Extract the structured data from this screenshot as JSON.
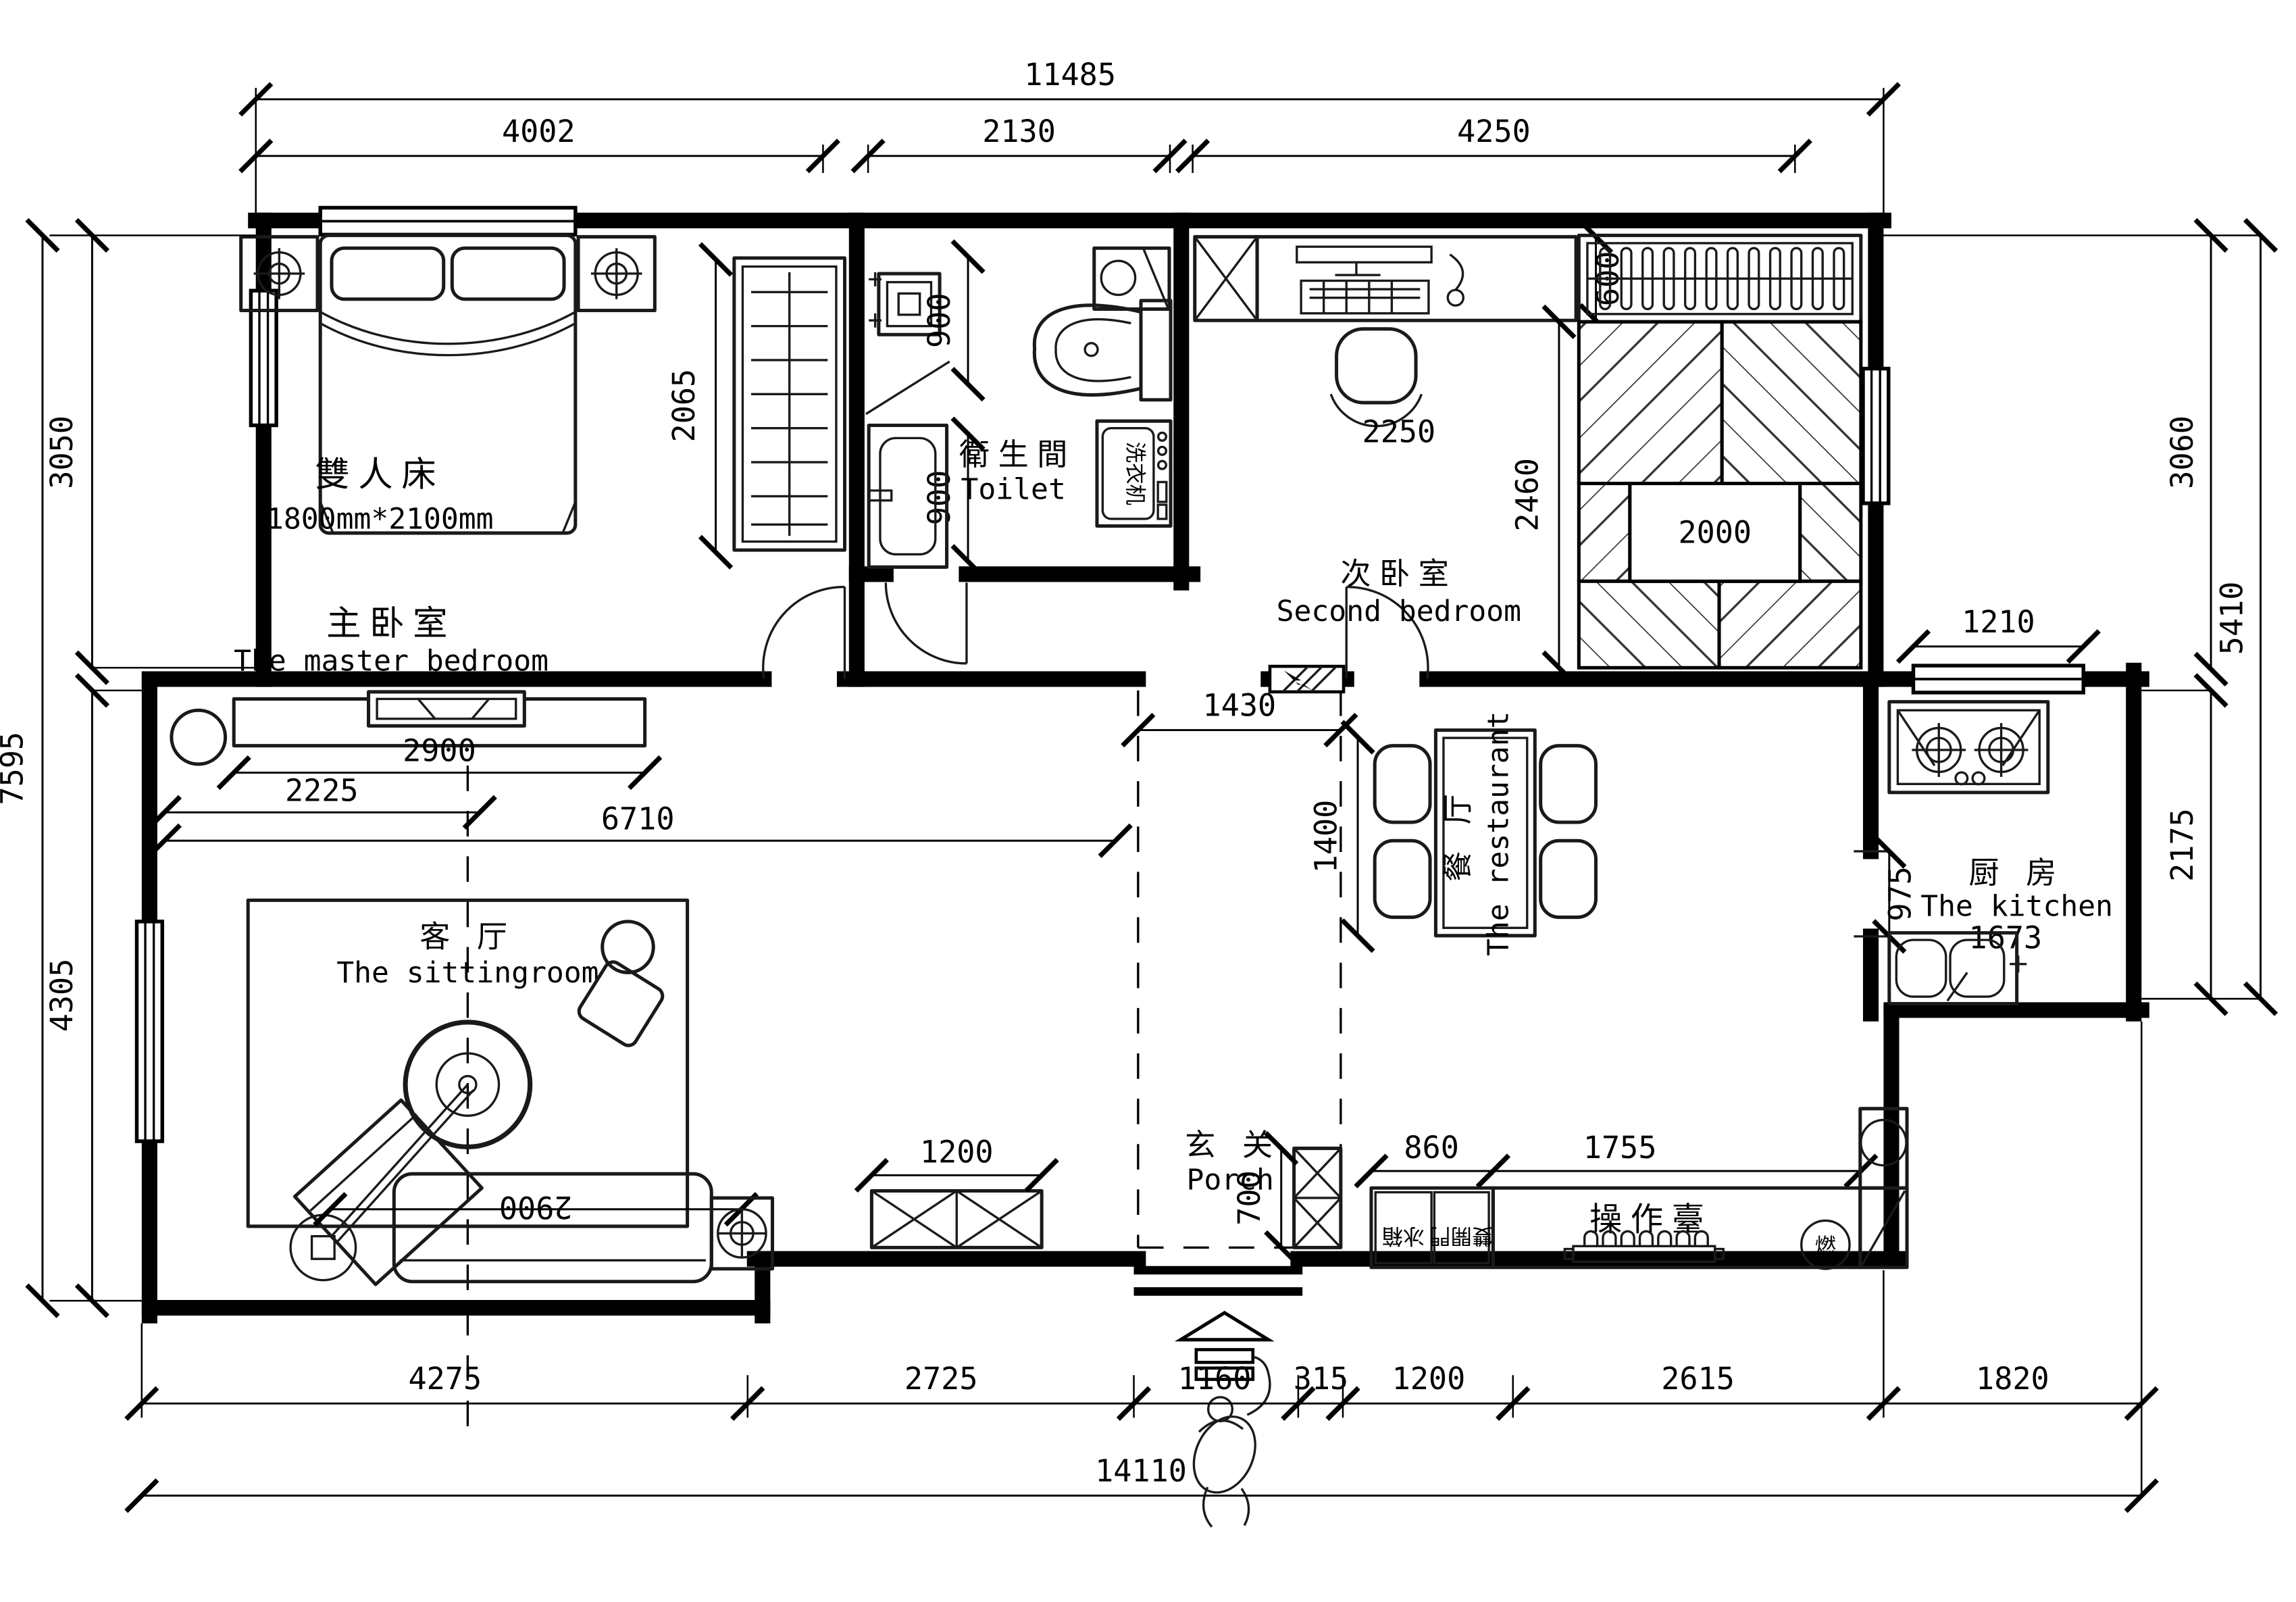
{
  "rooms": {
    "master_bedroom": {
      "zh": "主卧室",
      "en": "The master bedroom"
    },
    "second_bedroom": {
      "zh": "次卧室",
      "en": "Second bedroom"
    },
    "toilet": {
      "zh": "衛生間",
      "en": "Toilet"
    },
    "kitchen": {
      "zh": "厨 房",
      "en": "The kitchen"
    },
    "restaurant": {
      "zh": "餐 厅",
      "en": "The restaurant"
    },
    "sitting_room": {
      "zh": "客 厅",
      "en": "The sittingroom"
    },
    "porch": {
      "zh": "玄 关",
      "en": "Porch"
    }
  },
  "furniture": {
    "double_bed": "雙人床",
    "double_bed_size": "1800mm*2100mm",
    "washing_machine": "洗衣机",
    "counter": "操作臺",
    "fridge_left": "冰箱",
    "fridge_right": "雙開門",
    "gas_meter": "燃"
  },
  "dims": {
    "top_total": "11485",
    "top_master": "4002",
    "top_toilet": "2130",
    "top_second": "4250",
    "left_top": "3050",
    "left_total": "7595",
    "left_bottom": "4305",
    "right_top": "3060",
    "right_total": "5410",
    "right_kitchen": "2175",
    "b1": "4275",
    "b2": "2725",
    "b3": "1160",
    "b4": "315",
    "b5": "1200",
    "b6": "2615",
    "b7": "1820",
    "bottom_total": "14110",
    "wardrobe": "2065",
    "shower": "900",
    "vanity": "900",
    "desk_depth": "600",
    "desk_width": "2250",
    "tatami_len": "2460",
    "tatami_w": "2000",
    "kitchen_window": "1210",
    "dining": "1400",
    "kitchen_wall": "975",
    "kitchen_w": "1673",
    "porch_w": "1430",
    "tv_wall": "2900",
    "tv_offset": "2225",
    "living": "6710",
    "cabinet": "1200",
    "shoe": "700",
    "fridge_w": "860",
    "counter_w": "1755",
    "sofa": "2900"
  }
}
